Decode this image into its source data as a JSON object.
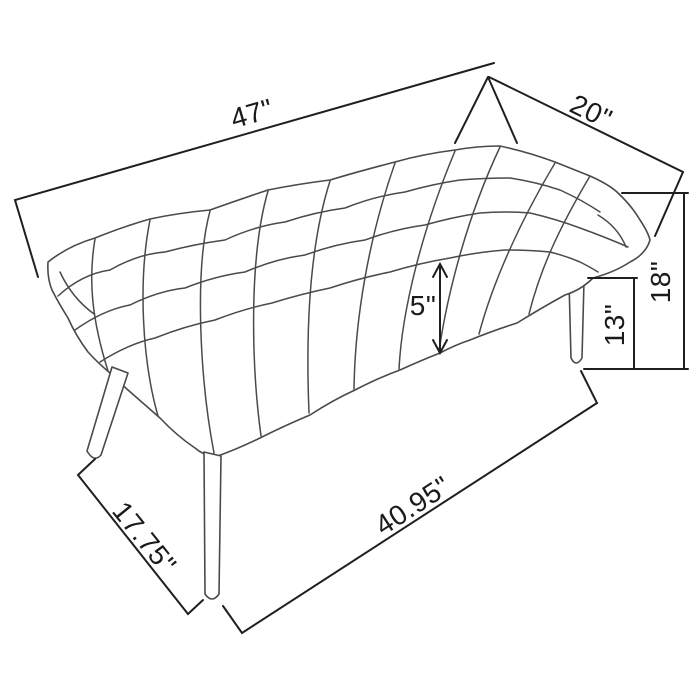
{
  "diagram": {
    "type": "furniture-dimension-diagram",
    "subject": "tufted bench line drawing",
    "dimensions": {
      "length": "47\"",
      "depth": "20\"",
      "overall_height": "18\"",
      "leg_height": "13\"",
      "seat_thickness": "5\"",
      "leg_span_side": "17.75\"",
      "leg_span_front": "40.95\""
    },
    "style": {
      "background_color": "#ffffff",
      "drawing_line_color": "#4a4a4a",
      "dimension_line_color": "#1f1f1f",
      "label_color": "#1a1a1a"
    }
  }
}
